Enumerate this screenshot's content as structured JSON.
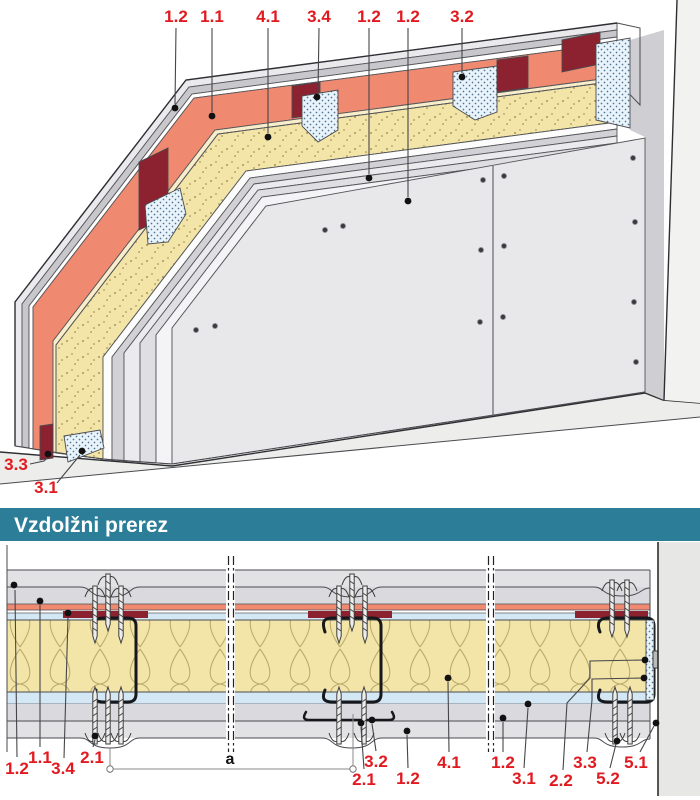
{
  "header": {
    "section_title": "Vzdolžni prerez"
  },
  "colors": {
    "teal": "#2b7d98",
    "label_red": "#e11a20",
    "salmon": "#ef8a71",
    "salmon_light": "#f8eecb",
    "dark_red": "#8c2130",
    "insulation_yellow": "#f3e5a8",
    "profile_blue": "#e9f3fb",
    "band_blue": "#d4e7f4",
    "panel_gray": "#e8e8ea",
    "strip_gray": "#c8c8cc",
    "wall_gray": "#f2f2f0",
    "floor_gray": "#ededeb",
    "outline": "#4a4b50"
  },
  "top_view": {
    "labels": [
      {
        "text": "1.2",
        "x": 176,
        "y": 22,
        "leader": [
          [
            176,
            28
          ],
          [
            175,
            104
          ]
        ],
        "dot": [
          175,
          108
        ]
      },
      {
        "text": "1.1",
        "x": 212,
        "y": 22,
        "leader": [
          [
            212,
            28
          ],
          [
            212,
            112
          ]
        ],
        "dot": [
          212,
          116
        ]
      },
      {
        "text": "4.1",
        "x": 268,
        "y": 22,
        "leader": [
          [
            268,
            28
          ],
          [
            268,
            133
          ]
        ],
        "dot": [
          268,
          137
        ]
      },
      {
        "text": "3.4",
        "x": 319,
        "y": 22,
        "leader": [
          [
            319,
            28
          ],
          [
            318,
            93
          ]
        ],
        "dot": [
          317,
          97
        ]
      },
      {
        "text": "1.2",
        "x": 369,
        "y": 22,
        "leader": [
          [
            369,
            28
          ],
          [
            369,
            174
          ]
        ],
        "dot": [
          369,
          178
        ]
      },
      {
        "text": "1.2",
        "x": 408,
        "y": 22,
        "leader": [
          [
            408,
            28
          ],
          [
            408,
            197
          ]
        ],
        "dot": [
          408,
          201
        ]
      },
      {
        "text": "3.2",
        "x": 462,
        "y": 22,
        "leader": [
          [
            462,
            28
          ],
          [
            462,
            73
          ]
        ],
        "dot": [
          462,
          77
        ]
      },
      {
        "text": "3.3",
        "x": 16,
        "y": 470,
        "leader": [
          [
            30,
            464
          ],
          [
            44,
            461
          ],
          [
            47,
            458
          ]
        ],
        "dot": [
          48,
          454
        ]
      },
      {
        "text": "3.1",
        "x": 46,
        "y": 493,
        "leader": [
          [
            57,
            483
          ],
          [
            80,
            455
          ]
        ],
        "dot": [
          82,
          451
        ]
      }
    ]
  },
  "section": {
    "labels": [
      {
        "text": "1.2",
        "x": 17,
        "y": 774,
        "leader": [
          [
            17,
            757
          ],
          [
            15,
            590
          ]
        ],
        "dot": [
          14,
          585
        ]
      },
      {
        "text": "1.1",
        "x": 40,
        "y": 763,
        "leader": [
          [
            40,
            747
          ],
          [
            40,
            605
          ]
        ],
        "dot": [
          40,
          601
        ]
      },
      {
        "text": "3.4",
        "x": 63,
        "y": 774,
        "leader": [
          [
            64,
            758
          ],
          [
            68,
            617
          ]
        ],
        "dot": [
          68,
          613
        ]
      },
      {
        "text": "2.1",
        "x": 92,
        "y": 763,
        "leader": [
          [
            93,
            747
          ],
          [
            95,
            740
          ]
        ],
        "dot": [
          95,
          736
        ]
      },
      {
        "text": "3.2",
        "x": 376,
        "y": 767,
        "leader": [
          [
            376,
            751
          ],
          [
            372,
            724
          ]
        ],
        "dot": [
          372,
          720
        ]
      },
      {
        "text": "2.1",
        "x": 364,
        "y": 785,
        "leader": [
          [
            364,
            769
          ],
          [
            361,
            727
          ]
        ],
        "dot": [
          361,
          723
        ]
      },
      {
        "text": "4.1",
        "x": 449,
        "y": 768,
        "leader": [
          [
            449,
            752
          ],
          [
            448,
            682
          ]
        ],
        "dot": [
          448,
          678
        ]
      },
      {
        "text": "1.2",
        "x": 408,
        "y": 784,
        "leader": [
          [
            408,
            768
          ],
          [
            407,
            735
          ]
        ],
        "dot": [
          407,
          731
        ]
      },
      {
        "text": "1.2",
        "x": 503,
        "y": 768,
        "leader": [
          [
            503,
            752
          ],
          [
            503,
            722
          ]
        ],
        "dot": [
          503,
          718
        ]
      },
      {
        "text": "3.1",
        "x": 524,
        "y": 784,
        "leader": [
          [
            524,
            768
          ],
          [
            528,
            708
          ]
        ],
        "dot": [
          528,
          704
        ]
      },
      {
        "text": "2.2",
        "x": 561,
        "y": 786,
        "leader": [
          [
            563,
            770
          ],
          [
            567,
            703
          ],
          [
            590,
            678
          ],
          [
            590,
            661
          ],
          [
            643,
            660
          ]
        ],
        "dot": [
          645,
          660
        ]
      },
      {
        "text": "3.3",
        "x": 585,
        "y": 768,
        "leader": [
          [
            587,
            752
          ],
          [
            592,
            700
          ],
          [
            592,
            679
          ],
          [
            642,
            678
          ]
        ],
        "dot": [
          644,
          678
        ]
      },
      {
        "text": "5.2",
        "x": 608,
        "y": 784,
        "leader": [
          [
            610,
            768
          ],
          [
            616,
            744
          ]
        ],
        "dot": [
          617,
          741
        ]
      },
      {
        "text": "5.1",
        "x": 636,
        "y": 768,
        "leader": [
          [
            640,
            752
          ],
          [
            654,
            726
          ]
        ],
        "dot": [
          656,
          723
        ]
      }
    ],
    "dimension": {
      "text": "a",
      "x1": 110,
      "x2": 353,
      "y": 769,
      "tick1_top": 748,
      "tick2_top": 714,
      "label_x": 230,
      "label_y": 764
    }
  }
}
